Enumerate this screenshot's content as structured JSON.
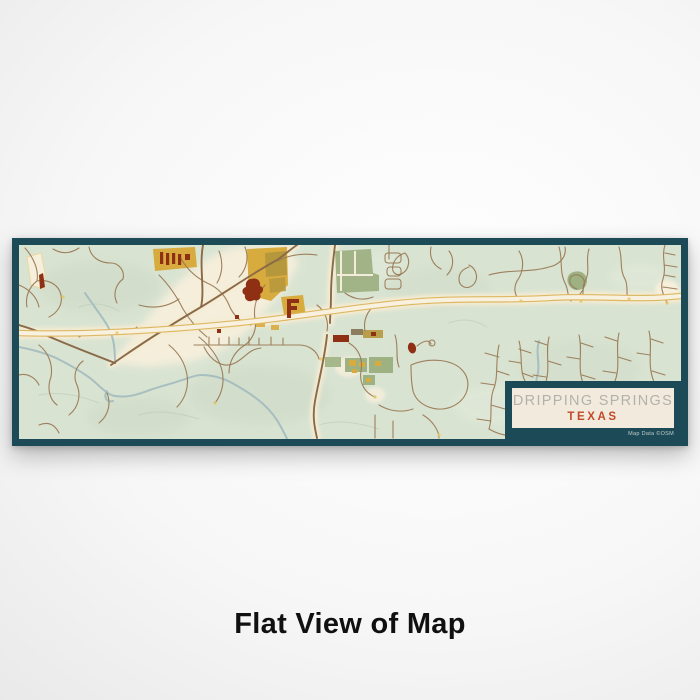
{
  "product_view": {
    "caption": "Flat View of Map",
    "map_print": {
      "title_card": {
        "city": "DRIPPING SPRINGS",
        "state": "TEXAS",
        "attribution": "Map Data ©OSM"
      },
      "colors": {
        "frame_teal": "#1c4a57",
        "map_background": "#d9e3d2",
        "road_minor": "#9a7a55",
        "road_highway_fill": "#f8f1df",
        "road_highway_casing": "#ddb863",
        "parcel_gold": "#d8ab3e",
        "parcel_olive": "#b5973c",
        "parcel_green": "#9eb183",
        "building_red": "#8f2f14",
        "water": "#9fb9bd",
        "card_background": "#f2ebdd",
        "card_city_text": "#b3b1ab",
        "card_state_text": "#c04a28"
      }
    }
  }
}
